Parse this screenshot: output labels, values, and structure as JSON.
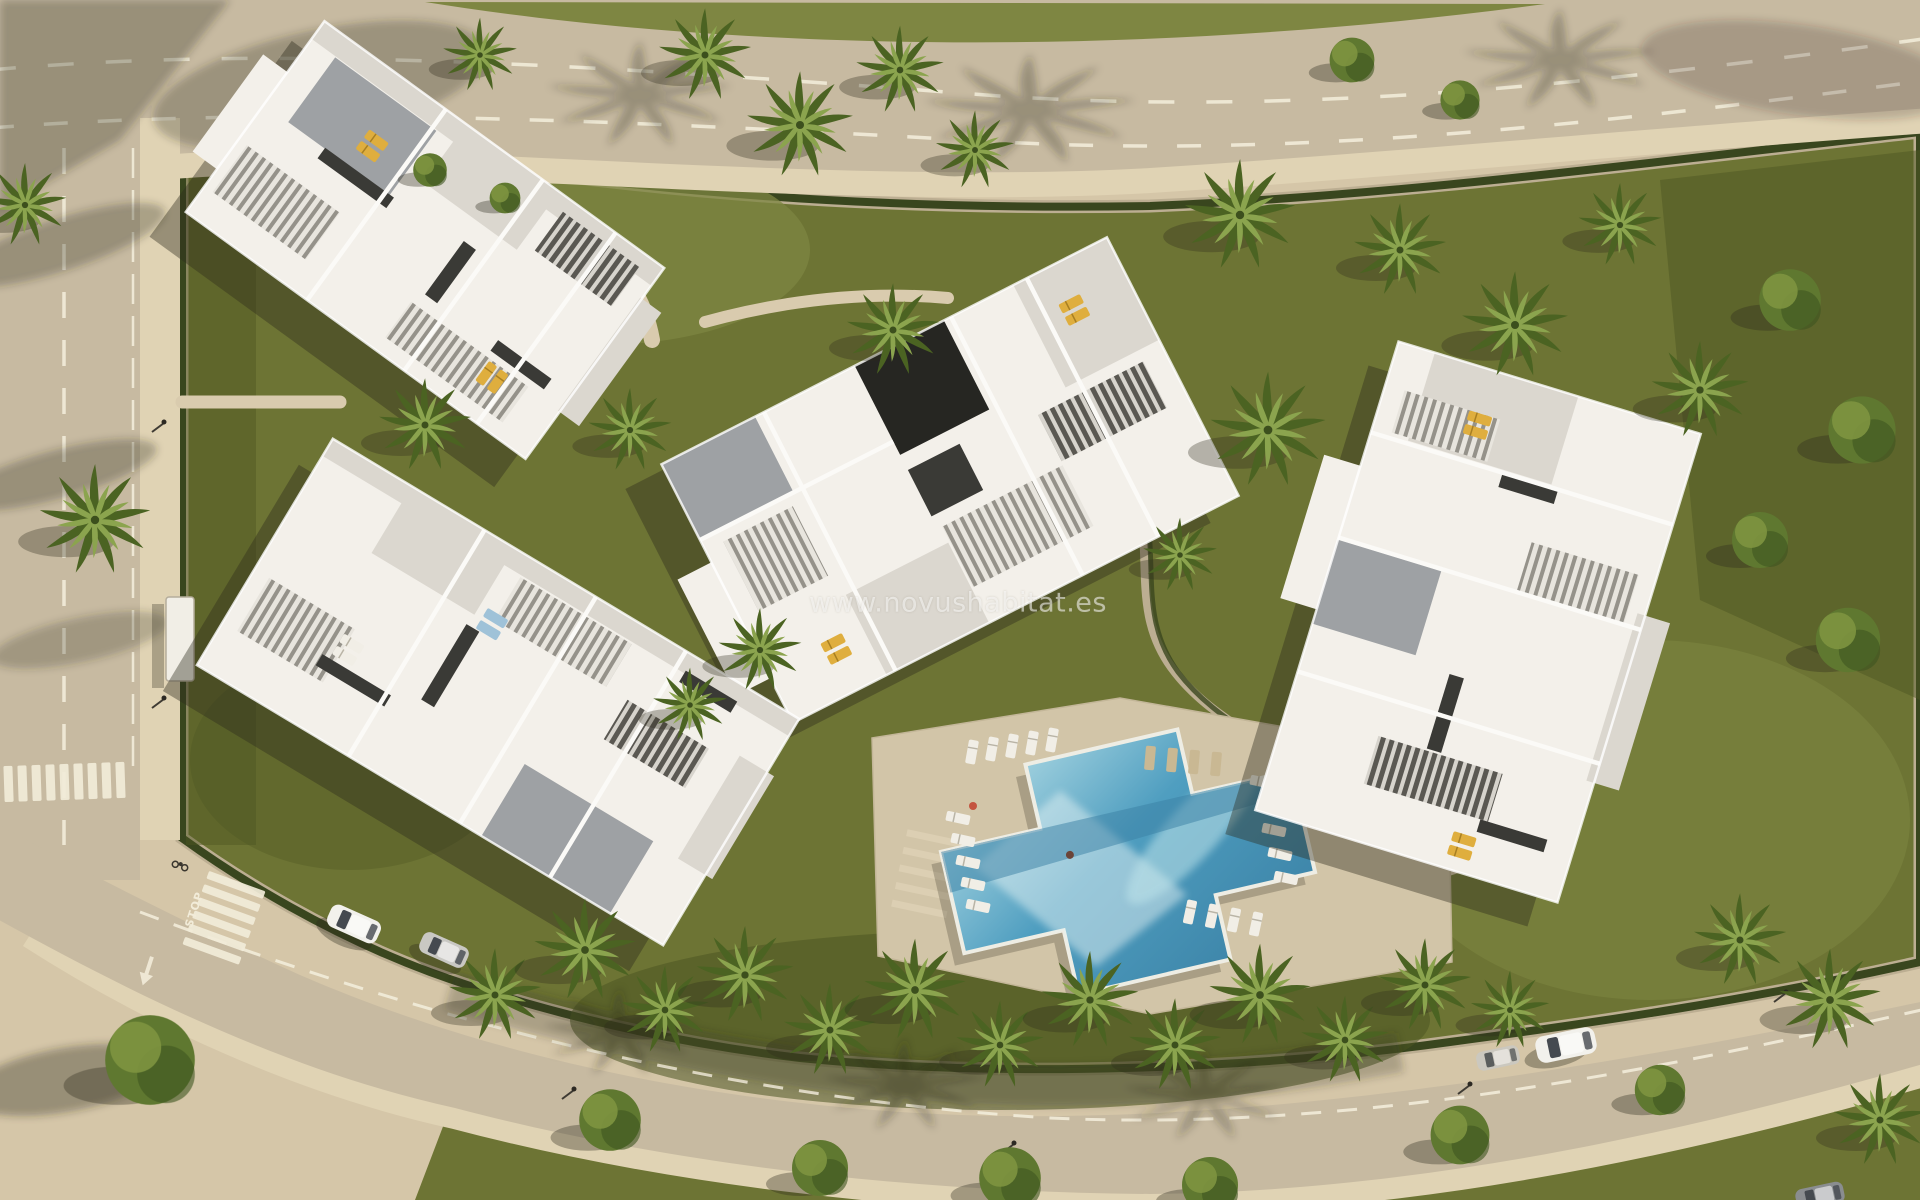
{
  "watermark": {
    "text": "www.novushabitat.es"
  },
  "road_markings": {
    "stop_text": "STOP"
  },
  "palette": {
    "sand": "#d5c6a8",
    "sandShade": "#b3a283",
    "road": "#c7baa1",
    "roadDark": "#a2937a",
    "sidewalk": "#e0d3b4",
    "marking": "#f2ecd9",
    "grass": "#6d7434",
    "grassLight": "#7e8642",
    "grassDark": "#4d5622",
    "hedge": "#39461e",
    "wall": "#bcae92",
    "path": "#d9cbae",
    "deck": "#d2c5a8",
    "pool": "#4f9ec0",
    "poolDeep": "#397fa3",
    "poolLight": "#bfe4ea",
    "poolEdge": "#eeede4",
    "building": "#f3f0ea",
    "buildingShade": "#dbd7cf",
    "buildingGray": "#9ea1a4",
    "buildingDark": "#3a3a36",
    "courtyardDark": "#262622",
    "slatLight": "#e8e5de",
    "slatLine": "#95928a",
    "slatDarkBg": "#5a5852",
    "slatDarkLine": "#d7d4cd",
    "lounger": "#f1eee6",
    "loungerYellow": "#dfae3e",
    "loungerBlue": "#9fc2d8",
    "loungerTan": "#c9b893",
    "palmDark": "#4b6322",
    "palmLight": "#8ba44e",
    "treeGreen": "#5f7830",
    "treeLight": "#7e9440",
    "treeDark": "#3e5520",
    "shadow": "#2f2b1d",
    "carWhite": "#f2f1ec",
    "carSilver": "#c9c8c3",
    "glass": "#454a50",
    "accentRed": "#c4543f"
  }
}
